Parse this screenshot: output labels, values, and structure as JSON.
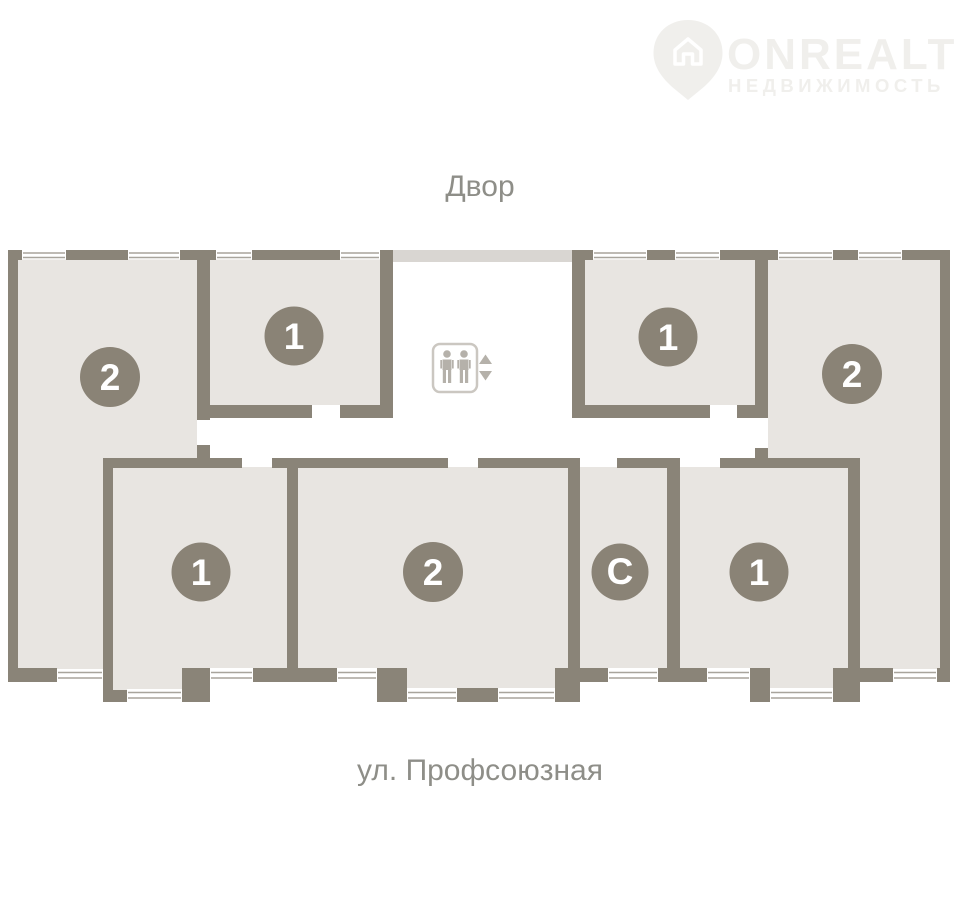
{
  "watermark": {
    "brand": "ONREALT",
    "subtitle": "НЕДВИЖИМОСТЬ"
  },
  "street_labels": {
    "top": "Двор",
    "bottom": "ул. Профсоюзная"
  },
  "apartments": [
    {
      "id": "apt-2-top-left",
      "label": "2"
    },
    {
      "id": "apt-1-top-left",
      "label": "1"
    },
    {
      "id": "apt-1-top-right",
      "label": "1"
    },
    {
      "id": "apt-2-right",
      "label": "2"
    },
    {
      "id": "apt-1-bottom-left",
      "label": "1"
    },
    {
      "id": "apt-2-bottom-center",
      "label": "2"
    },
    {
      "id": "apt-studio",
      "label": "С"
    },
    {
      "id": "apt-1-bottom-right",
      "label": "1"
    }
  ],
  "colors": {
    "wall": "#8a8478",
    "room_fill": "#e8e5e1",
    "badge": "#8a8376",
    "badge_text": "#ffffff",
    "window_line": "#a8a49c",
    "street_text": "#8e8e88",
    "watermark": "#f0efec",
    "lobby_strip": "#d9d6d2",
    "elevator_icon": "#b5b1aa"
  }
}
